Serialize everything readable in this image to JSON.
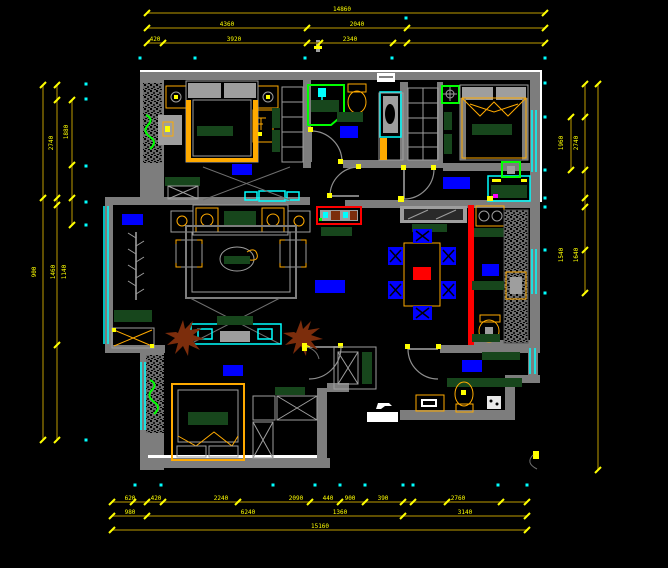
{
  "meta": {
    "type": "cad-floor-plan-drawing",
    "description": "Apartment floor plan on black CAD canvas with yellow dimension chains"
  },
  "palette": {
    "bg": "#000000",
    "wall": "#7d7d7d",
    "wallLight": "#9e9e9e",
    "white": "#ffffff",
    "dim": "#7f6800",
    "yel": "#ffff00",
    "cyan": "#00ffff",
    "blue": "#0000ff",
    "dgreen": "#17461c",
    "green": "#00ff00",
    "orange": "#ffaa00",
    "red": "#ff0000",
    "brown": "#7c2d0c",
    "magenta": "#ff00ff"
  },
  "dim_chains": [
    {
      "o": "h",
      "y": 13,
      "x1": 147,
      "x2": 545,
      "ticks": [
        147,
        545
      ]
    },
    {
      "o": "h",
      "y": 28,
      "x1": 147,
      "x2": 545,
      "ticks": [
        147,
        307,
        407,
        545
      ]
    },
    {
      "o": "h",
      "y": 43,
      "x1": 147,
      "x2": 545,
      "ticks": [
        147,
        163,
        307,
        320,
        393,
        407,
        545
      ]
    },
    {
      "o": "h",
      "y": 502,
      "x1": 112,
      "x2": 527,
      "ticks": [
        112,
        133,
        147,
        163,
        238,
        310,
        340,
        365,
        403,
        413,
        447,
        501,
        527
      ]
    },
    {
      "o": "h",
      "y": 516,
      "x1": 112,
      "x2": 527,
      "ticks": [
        112,
        147,
        403,
        527
      ]
    },
    {
      "o": "h",
      "y": 530,
      "x1": 112,
      "x2": 527,
      "ticks": [
        112,
        527
      ]
    },
    {
      "o": "v",
      "x": 43,
      "y1": 85,
      "y2": 440,
      "ticks": [
        85,
        198,
        440
      ]
    },
    {
      "o": "v",
      "x": 57,
      "y1": 85,
      "y2": 440,
      "ticks": [
        85,
        100,
        198,
        205,
        345,
        440
      ]
    },
    {
      "o": "v",
      "x": 72,
      "y1": 100,
      "y2": 225,
      "ticks": [
        100,
        165,
        198,
        225
      ]
    },
    {
      "o": "v",
      "x": 571,
      "y1": 117,
      "y2": 170,
      "ticks": [
        117,
        170
      ]
    },
    {
      "o": "v",
      "x": 585,
      "y1": 84,
      "y2": 293,
      "ticks": [
        84,
        117,
        170,
        198,
        207,
        250,
        293
      ]
    },
    {
      "o": "v",
      "x": 598,
      "y1": 84,
      "y2": 470,
      "ticks": [
        84,
        470
      ]
    }
  ],
  "dim_labels": [
    {
      "x": 342,
      "y": 11,
      "t": "14860",
      "r": 0
    },
    {
      "x": 227,
      "y": 26,
      "t": "4360",
      "r": 0
    },
    {
      "x": 357,
      "y": 26,
      "t": "2040",
      "r": 0
    },
    {
      "x": 155,
      "y": 41,
      "t": "420",
      "r": 0
    },
    {
      "x": 234,
      "y": 41,
      "t": "3920",
      "r": 0
    },
    {
      "x": 350,
      "y": 41,
      "t": "2340",
      "r": 0
    },
    {
      "x": 130,
      "y": 500,
      "t": "620",
      "r": 0
    },
    {
      "x": 156,
      "y": 500,
      "t": "420",
      "r": 0
    },
    {
      "x": 221,
      "y": 500,
      "t": "2240",
      "r": 0
    },
    {
      "x": 296,
      "y": 500,
      "t": "2090",
      "r": 0
    },
    {
      "x": 328,
      "y": 500,
      "t": "440",
      "r": 0
    },
    {
      "x": 350,
      "y": 500,
      "t": "900",
      "r": 0
    },
    {
      "x": 383,
      "y": 500,
      "t": "390",
      "r": 0
    },
    {
      "x": 458,
      "y": 500,
      "t": "2760",
      "r": 0
    },
    {
      "x": 130,
      "y": 514,
      "t": "980",
      "r": 0
    },
    {
      "x": 248,
      "y": 514,
      "t": "6240",
      "r": 0
    },
    {
      "x": 340,
      "y": 514,
      "t": "1360",
      "r": 0
    },
    {
      "x": 465,
      "y": 514,
      "t": "3140",
      "r": 0
    },
    {
      "x": 320,
      "y": 528,
      "t": "15160",
      "r": 0
    },
    {
      "x": 53,
      "y": 143,
      "t": "2740",
      "r": -90
    },
    {
      "x": 68,
      "y": 132,
      "t": "1880",
      "r": -90
    },
    {
      "x": 36,
      "y": 272,
      "t": "900",
      "r": -90
    },
    {
      "x": 55,
      "y": 272,
      "t": "1460",
      "r": -90
    },
    {
      "x": 66,
      "y": 272,
      "t": "1140",
      "r": -90
    },
    {
      "x": 563,
      "y": 143,
      "t": "1960",
      "r": -90
    },
    {
      "x": 578,
      "y": 143,
      "t": "2740",
      "r": -90
    },
    {
      "x": 563,
      "y": 255,
      "t": "1540",
      "r": -90
    },
    {
      "x": 578,
      "y": 255,
      "t": "1640",
      "r": -90
    }
  ],
  "cyan_dots": [
    {
      "x": 140,
      "y": 58
    },
    {
      "x": 195,
      "y": 58
    },
    {
      "x": 305,
      "y": 58
    },
    {
      "x": 392,
      "y": 58
    },
    {
      "x": 406,
      "y": 18
    },
    {
      "x": 545,
      "y": 58
    },
    {
      "x": 135,
      "y": 485
    },
    {
      "x": 161,
      "y": 485
    },
    {
      "x": 273,
      "y": 485
    },
    {
      "x": 315,
      "y": 485
    },
    {
      "x": 340,
      "y": 485
    },
    {
      "x": 365,
      "y": 485
    },
    {
      "x": 403,
      "y": 485
    },
    {
      "x": 413,
      "y": 485
    },
    {
      "x": 498,
      "y": 485
    },
    {
      "x": 527,
      "y": 485
    },
    {
      "x": 86,
      "y": 84
    },
    {
      "x": 86,
      "y": 99
    },
    {
      "x": 86,
      "y": 166
    },
    {
      "x": 86,
      "y": 202
    },
    {
      "x": 86,
      "y": 225
    },
    {
      "x": 86,
      "y": 440
    },
    {
      "x": 545,
      "y": 83
    },
    {
      "x": 545,
      "y": 117
    },
    {
      "x": 545,
      "y": 170
    },
    {
      "x": 545,
      "y": 198
    },
    {
      "x": 545,
      "y": 207
    },
    {
      "x": 545,
      "y": 250
    },
    {
      "x": 545,
      "y": 293
    }
  ],
  "room_label_blocks": [
    {
      "name": "label-bedroom-top-left",
      "x": 232,
      "y": 164,
      "w": 20,
      "h": 11
    },
    {
      "name": "label-balcony",
      "x": 122,
      "y": 214,
      "w": 21,
      "h": 11
    },
    {
      "name": "label-living-room",
      "x": 315,
      "y": 280,
      "w": 30,
      "h": 13
    },
    {
      "name": "label-bathroom-top",
      "x": 340,
      "y": 126,
      "w": 18,
      "h": 12
    },
    {
      "name": "label-bedroom-top-right",
      "x": 443,
      "y": 177,
      "w": 27,
      "h": 12
    },
    {
      "name": "label-kitchen",
      "x": 482,
      "y": 264,
      "w": 17,
      "h": 12
    },
    {
      "name": "label-bedroom-bottom",
      "x": 223,
      "y": 365,
      "w": 20,
      "h": 11
    },
    {
      "name": "label-hall-bathroom",
      "x": 462,
      "y": 360,
      "w": 20,
      "h": 12
    }
  ]
}
